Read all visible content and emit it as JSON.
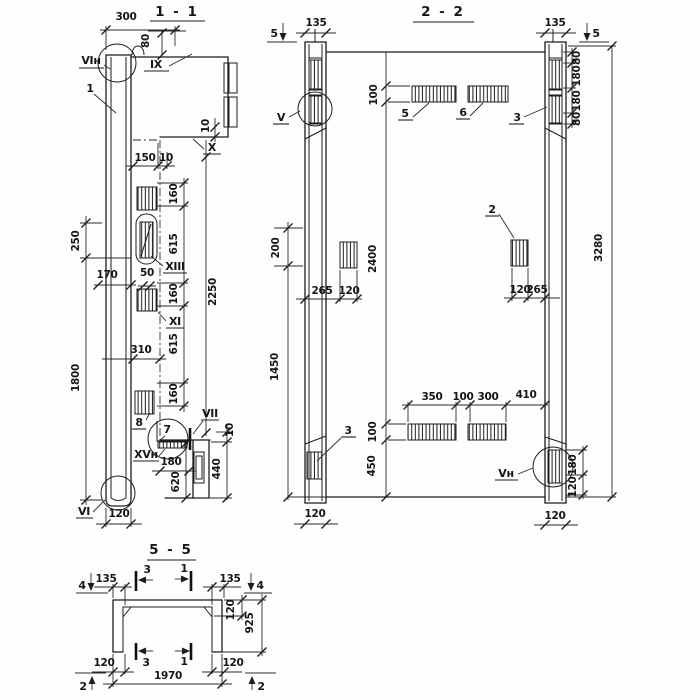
{
  "drawing": {
    "s11": {
      "title": "1 - 1",
      "labels": {
        "vi_top": "VIн",
        "callout1": "1",
        "ix": "IX",
        "x": "X",
        "xiii": "XIII",
        "xi": "XI",
        "n8": "8",
        "n7": "7",
        "vii": "VII",
        "xv": "XVн",
        "vi_bottom": "VI"
      },
      "dims": {
        "top300": "300",
        "top80": "80",
        "step150": "150",
        "step10": "10",
        "edge10": "10",
        "left250": "250",
        "left1800": "1800",
        "left170": "170",
        "small50": "50",
        "mid310": "310",
        "chain": [
          "160",
          "615",
          "160",
          "615",
          "160"
        ],
        "overall2250": "2250",
        "bot180": "180",
        "bot620": "620",
        "bot440": "440",
        "bot10": "10",
        "bot120": "120"
      }
    },
    "s22": {
      "title": "2 - 2",
      "labels": {
        "v": "V",
        "vn": "Vн",
        "p5": "5",
        "p6": "6",
        "p3top": "3",
        "p3bot": "3",
        "p2": "2"
      },
      "markers": {
        "left5": "5",
        "right5": "5"
      },
      "dims": {
        "col135L": "135",
        "col135R": "135",
        "plate100top": "100",
        "rightChain": [
          "80",
          "180",
          "180",
          "80"
        ],
        "left200": "200",
        "mid2400": "2400",
        "overall3280": "3280",
        "leftMid": [
          "265",
          "120"
        ],
        "rightMid": [
          "120",
          "265"
        ],
        "bottomRow": [
          "350",
          "100",
          "300",
          "410"
        ],
        "plate100bot": "100",
        "bot450": "450",
        "left1450": "1450",
        "br180": "180",
        "br120": "120",
        "foot120L": "120",
        "foot120R": "120"
      }
    },
    "s55": {
      "title": "5 - 5",
      "markers": {
        "m4L": "4",
        "m4R": "4",
        "m2L": "2",
        "m2R": "2",
        "cut3top": "3",
        "cut1top": "1",
        "cut3bot": "3",
        "cut1bot": "1"
      },
      "dims": {
        "f135L": "135",
        "f135R": "135",
        "side120": "120",
        "side925": "925",
        "foot120L": "120",
        "foot120R": "120",
        "width1970": "1970"
      }
    }
  }
}
